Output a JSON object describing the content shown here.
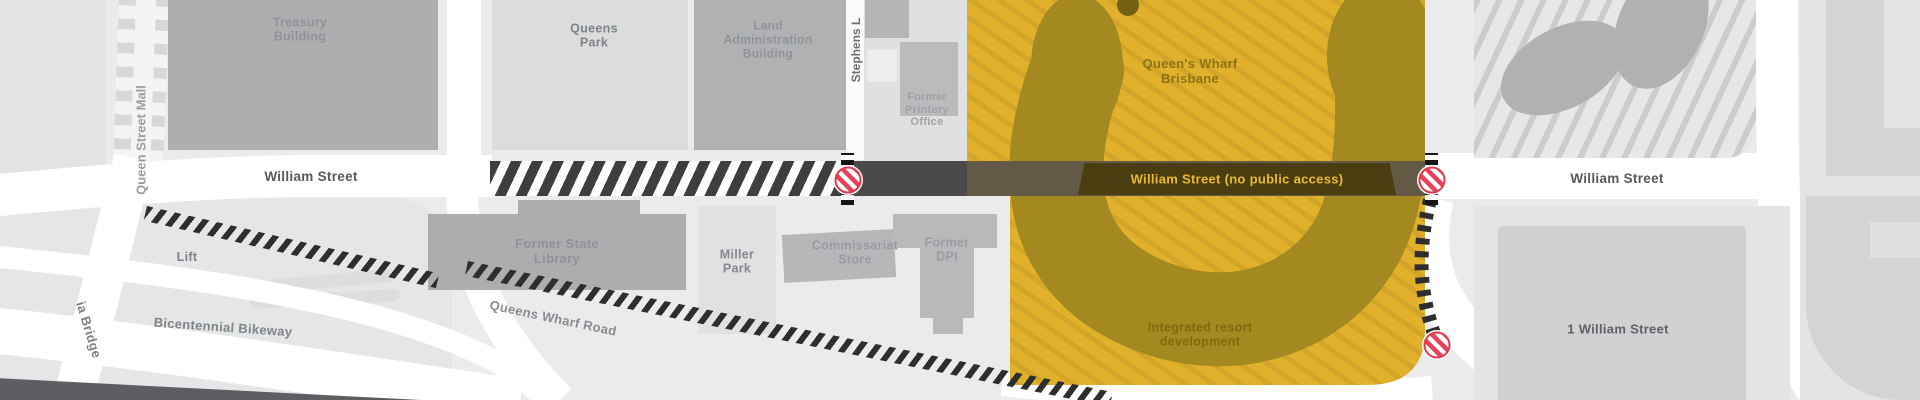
{
  "title": "Queen's Wharf Brisbane precinct map",
  "colors": {
    "background": "#EAEBEC",
    "development_yellow": "#E2B12C",
    "development_hatch": "#CFA329",
    "development_olive": "#A3891F",
    "closed_street_dark": "#4B4A49",
    "no_access_band": "#4A3D0F",
    "no_access_text": "#ECBA2E",
    "street_white": "#FFFFFF",
    "building_gray": "#AEB0B2",
    "no_entry_red": "#E23B50",
    "ladder_dark": "#2E2E2E"
  },
  "labels": {
    "queen_street_mall": "Queen Street Mall",
    "treasury_building": "Treasury\nBuilding",
    "queens_park": "Queens\nPark",
    "land_administration_building": "Land\nAdministration\nBuilding",
    "stephens_lane": "Stephens L",
    "former_printery_office": "Former\nPrintery\nOffice",
    "william_street_left": "William Street",
    "william_street_no_access": "William Street (no public access)",
    "william_street_right": "William Street",
    "queens_wharf_brisbane": "Queen's Wharf\nBrisbane",
    "integrated_resort_development": "Integrated resort\ndevelopment",
    "former_state_library": "Former State\nLibrary",
    "miller_park": "Miller\nPark",
    "commissariat_store": "Commissariat\nStore",
    "former_dpi": "Former\nDPI",
    "lift": "Lift",
    "bicentennial_bikeway": "Bicentennial Bikeway",
    "queens_wharf_road": "Queens Wharf Road",
    "victoria_bridge": "ia Bridge",
    "one_william_street": "1 William Street"
  },
  "icons": {
    "no_entry": "road closed to public"
  }
}
